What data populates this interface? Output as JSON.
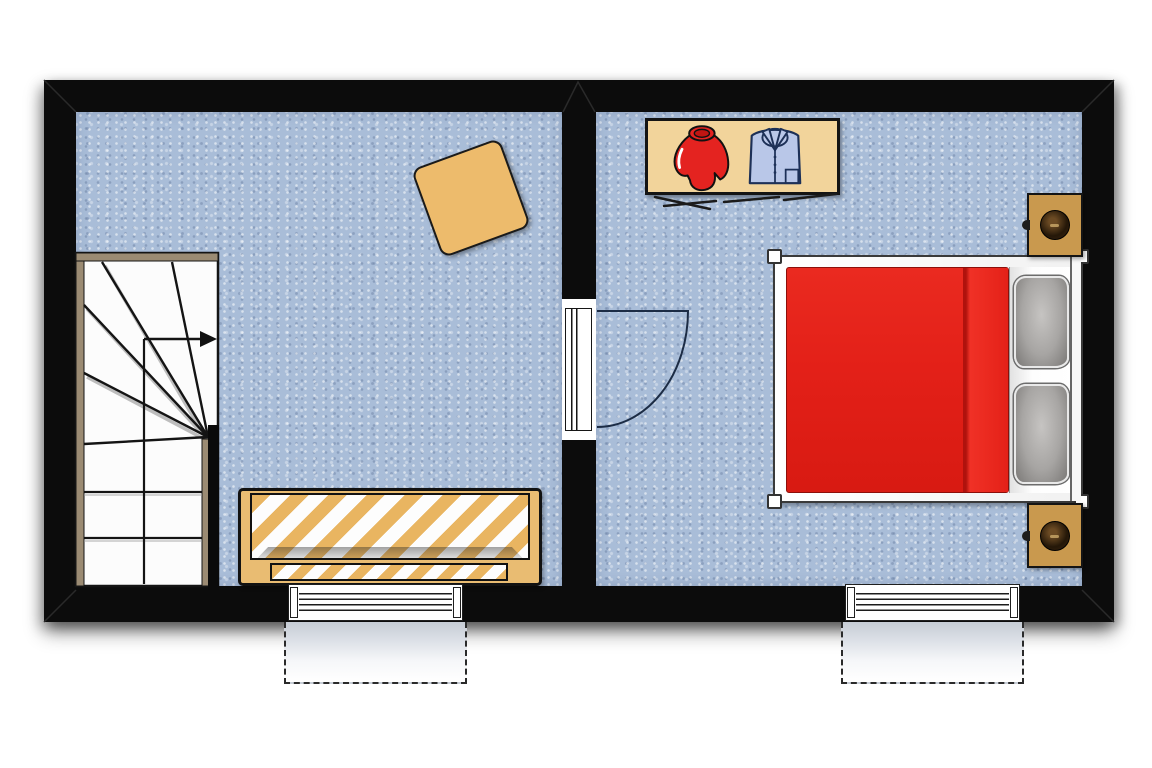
{
  "document": {
    "type": "floor-plan",
    "rooms_count": 2,
    "visible_text": ""
  },
  "colors": {
    "wall": "#0c0c0c",
    "floor": "#a9bdd8",
    "stair_trim": "#9b8b73",
    "stair_tread": "#fcfcfc",
    "rug_tan": "#edbb6c",
    "sofa_frame_tan": "#e9bc72",
    "stripe_orange": "#e9b561",
    "stripe_white": "#fdfdfd",
    "wardrobe_tan": "#f2d49b",
    "sweater_red": "#e42320",
    "shirt_blue": "#b9c7e8",
    "shirt_outline": "#1d3057",
    "bed_red": "#e32018",
    "bed_red_dark": "#b0120d",
    "pillow_grey": "#a7a5a3",
    "pillow_grey_dark": "#7a7876",
    "nightstand_tan": "#c9994e",
    "lamp_dark": "#241708",
    "door_arc": "#1c2c45",
    "dormer_grey": "#c6ccd5",
    "outline_black": "#141414"
  },
  "rooms": [
    {
      "id": "left-room",
      "furniture": [
        {
          "item": "winder-staircase",
          "straight_treads": 4,
          "winder_treads": 6,
          "direction": "up then turning right"
        },
        {
          "item": "square-rug",
          "rotation_deg": -20
        },
        {
          "item": "striped-daybed",
          "pattern": "orange-white diagonal stripes"
        }
      ],
      "openings": [
        {
          "type": "window",
          "wall": "bottom",
          "dormer": true
        }
      ]
    },
    {
      "id": "bedroom",
      "furniture": [
        {
          "item": "open-wardrobe",
          "contents": [
            "red-sweater",
            "blue-shirt"
          ]
        },
        {
          "item": "double-bed",
          "duvet": "red",
          "pillows": 2,
          "headboard_side": "right"
        },
        {
          "item": "nightstand",
          "accessory": "lamp",
          "position": "top-right"
        },
        {
          "item": "nightstand",
          "accessory": "lamp",
          "position": "bottom-right"
        }
      ],
      "openings": [
        {
          "type": "door",
          "wall": "left",
          "swing": "opens into bedroom"
        },
        {
          "type": "window",
          "wall": "bottom",
          "dormer": true
        }
      ]
    }
  ]
}
